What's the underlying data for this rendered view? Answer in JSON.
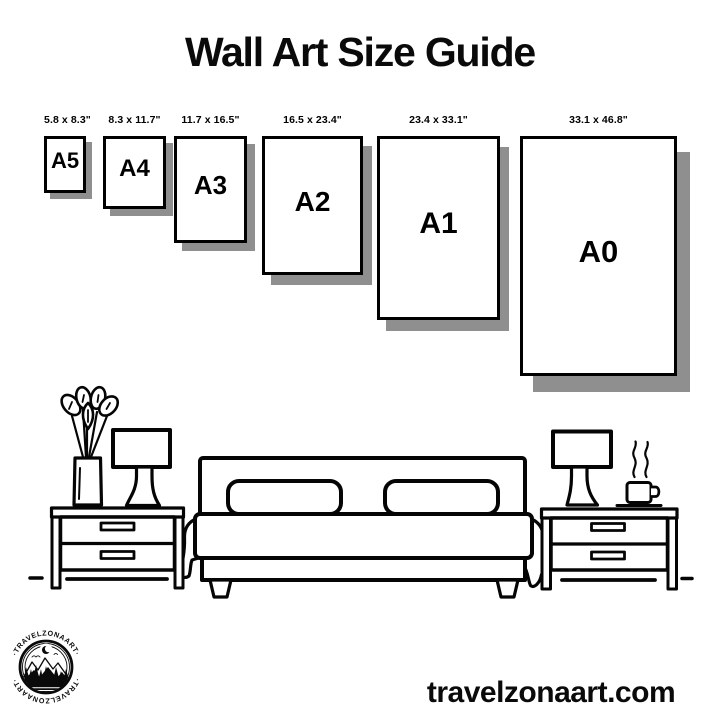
{
  "title": "Wall Art Size Guide",
  "colors": {
    "ink": "#000000",
    "paper": "#ffffff",
    "frame_shadow": "#8f8f8f"
  },
  "size_guide": {
    "frames": [
      {
        "code": "A5",
        "dimensions": "5.8 x 8.3\""
      },
      {
        "code": "A4",
        "dimensions": "8.3 x 11.7\""
      },
      {
        "code": "A3",
        "dimensions": "11.7 x 16.5\""
      },
      {
        "code": "A2",
        "dimensions": "16.5 x 23.4\""
      },
      {
        "code": "A1",
        "dimensions": "23.4 x 33.1\""
      },
      {
        "code": "A0",
        "dimensions": "33.1 x 46.8\""
      }
    ]
  },
  "illustration": {
    "scene": "bedroom-line-art",
    "elements": [
      "potted-plant",
      "table-lamp-left",
      "nightstand-left",
      "double-bed-with-pillows",
      "nightstand-right",
      "table-lamp-right",
      "steaming-coffee-cup",
      "floor-line"
    ]
  },
  "footer": {
    "brand_arc_top": "·TRAVELZONAART·",
    "brand_arc_bottom": "·TRAVELZONAART·",
    "website": "travelzonaart.com"
  }
}
